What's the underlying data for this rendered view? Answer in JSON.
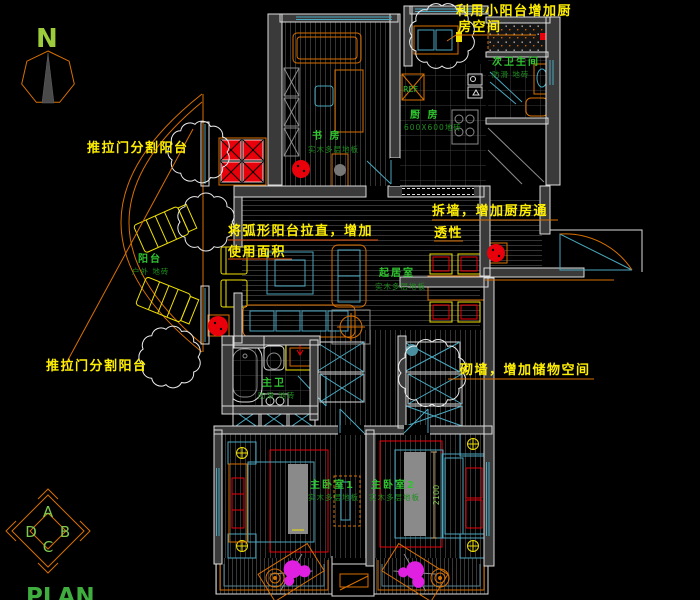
{
  "drawing": {
    "north_label": "N",
    "plan_label": "PLAN",
    "fridge_label": "REF",
    "dimension_text": "2100",
    "elevation_marker": {
      "top": "A",
      "right": "B",
      "bottom": "C",
      "left": "D"
    }
  },
  "annotations": {
    "use_small_balcony_line1": "利用小阳台增加厨",
    "use_small_balcony_line2": "房空间",
    "sliding_door_top": "推拉门分割阳台",
    "straighten_balcony_line1": "将弧形阳台拉直，增加",
    "straighten_balcony_line2": "使用面积",
    "demolish_wall_line1": "拆墙，增加厨房通",
    "demolish_wall_line2": "透性",
    "sliding_door_bottom": "推拉门分割阳台",
    "build_wall": "砌墙，增加储物空间"
  },
  "rooms": {
    "study": {
      "name": "书 房",
      "floor": "实木多层地板"
    },
    "kitchen": {
      "name": "厨  房",
      "floor": "600X600地砖"
    },
    "second_bathroom": {
      "name": "次卫生间",
      "floor": "防滑 地砖"
    },
    "balcony": {
      "name": "阳台",
      "floor": "户外 地砖"
    },
    "living_room": {
      "name": "起居室",
      "floor": "实木多层地板"
    },
    "master_bathroom": {
      "name": "主卫",
      "floor": "防滑 地砖"
    },
    "master_bedroom1": {
      "name": "主卧室1",
      "floor": "实木多层地板"
    },
    "master_bedroom2": {
      "name": "主卧室2",
      "floor": "实木多层地板"
    }
  },
  "colors": {
    "background": "#000000",
    "wall_fill": "#3a3a3a",
    "wall_outline": "#dcdcdc",
    "annotation_yellow": "#ffef00",
    "label_green": "#2fc52f",
    "furniture_orange": "#d97000",
    "fixture_cyan": "#4aa8c0",
    "marker_red": "#e8000a",
    "plant_magenta": "#e020e0"
  }
}
